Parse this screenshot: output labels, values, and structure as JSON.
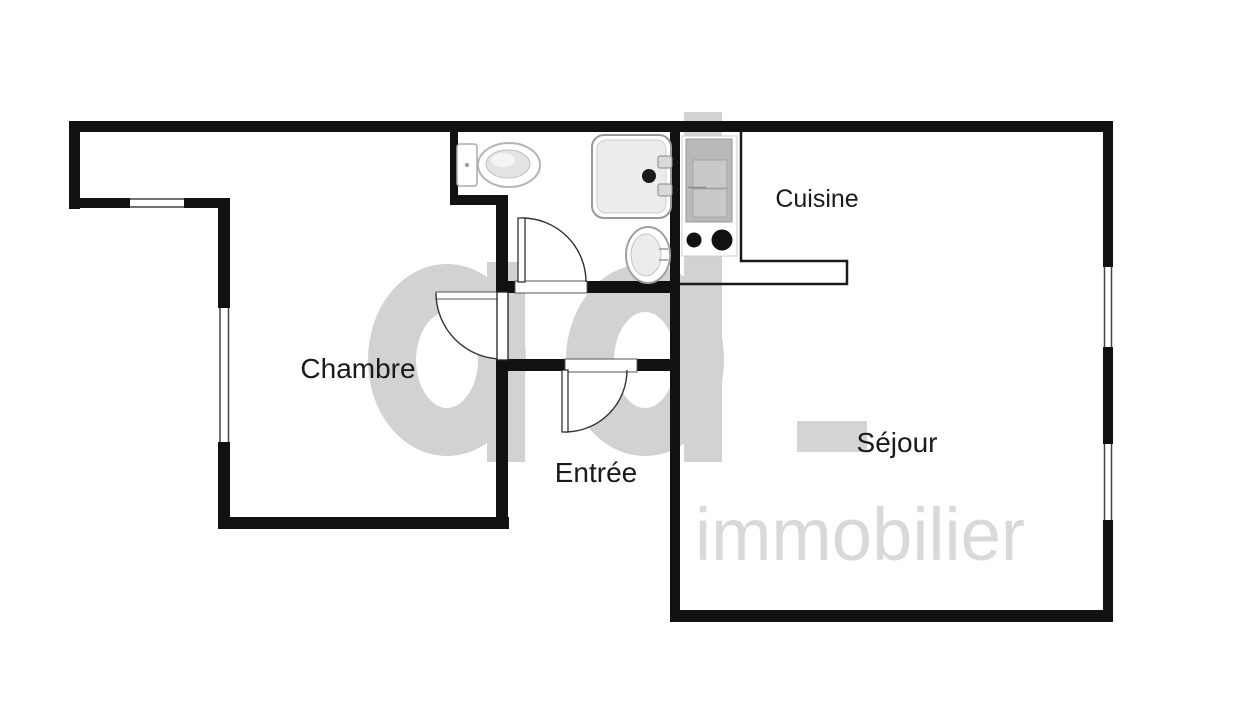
{
  "image_type": "apartment floor plan",
  "rooms": {
    "chambre": "Chambre",
    "cuisine": "Cuisine",
    "entree": "Entrée",
    "sejour": "Séjour"
  },
  "watermark": {
    "logo": "ad",
    "word": "immobilier",
    "logo_color": "#d2d2d2",
    "word_color": "#d9d9d9"
  },
  "colors": {
    "background": "#ffffff",
    "wall": "#111111",
    "label": "#1a1a1a",
    "door_line": "#333333",
    "threshold_line": "#555555",
    "fixture_outline": "#9c9c9c",
    "burner": "#111111"
  },
  "fixtures": {
    "bathroom": [
      "toilet",
      "shower",
      "washbasin"
    ],
    "kitchen": [
      "kitchen-unit",
      "two-burner-stove",
      "counter"
    ]
  },
  "doors": [
    "chambre-door",
    "bathroom-door",
    "entree-door"
  ],
  "windows": [
    "notch-window",
    "chambre-window",
    "sejour-window-upper",
    "sejour-window-lower"
  ]
}
